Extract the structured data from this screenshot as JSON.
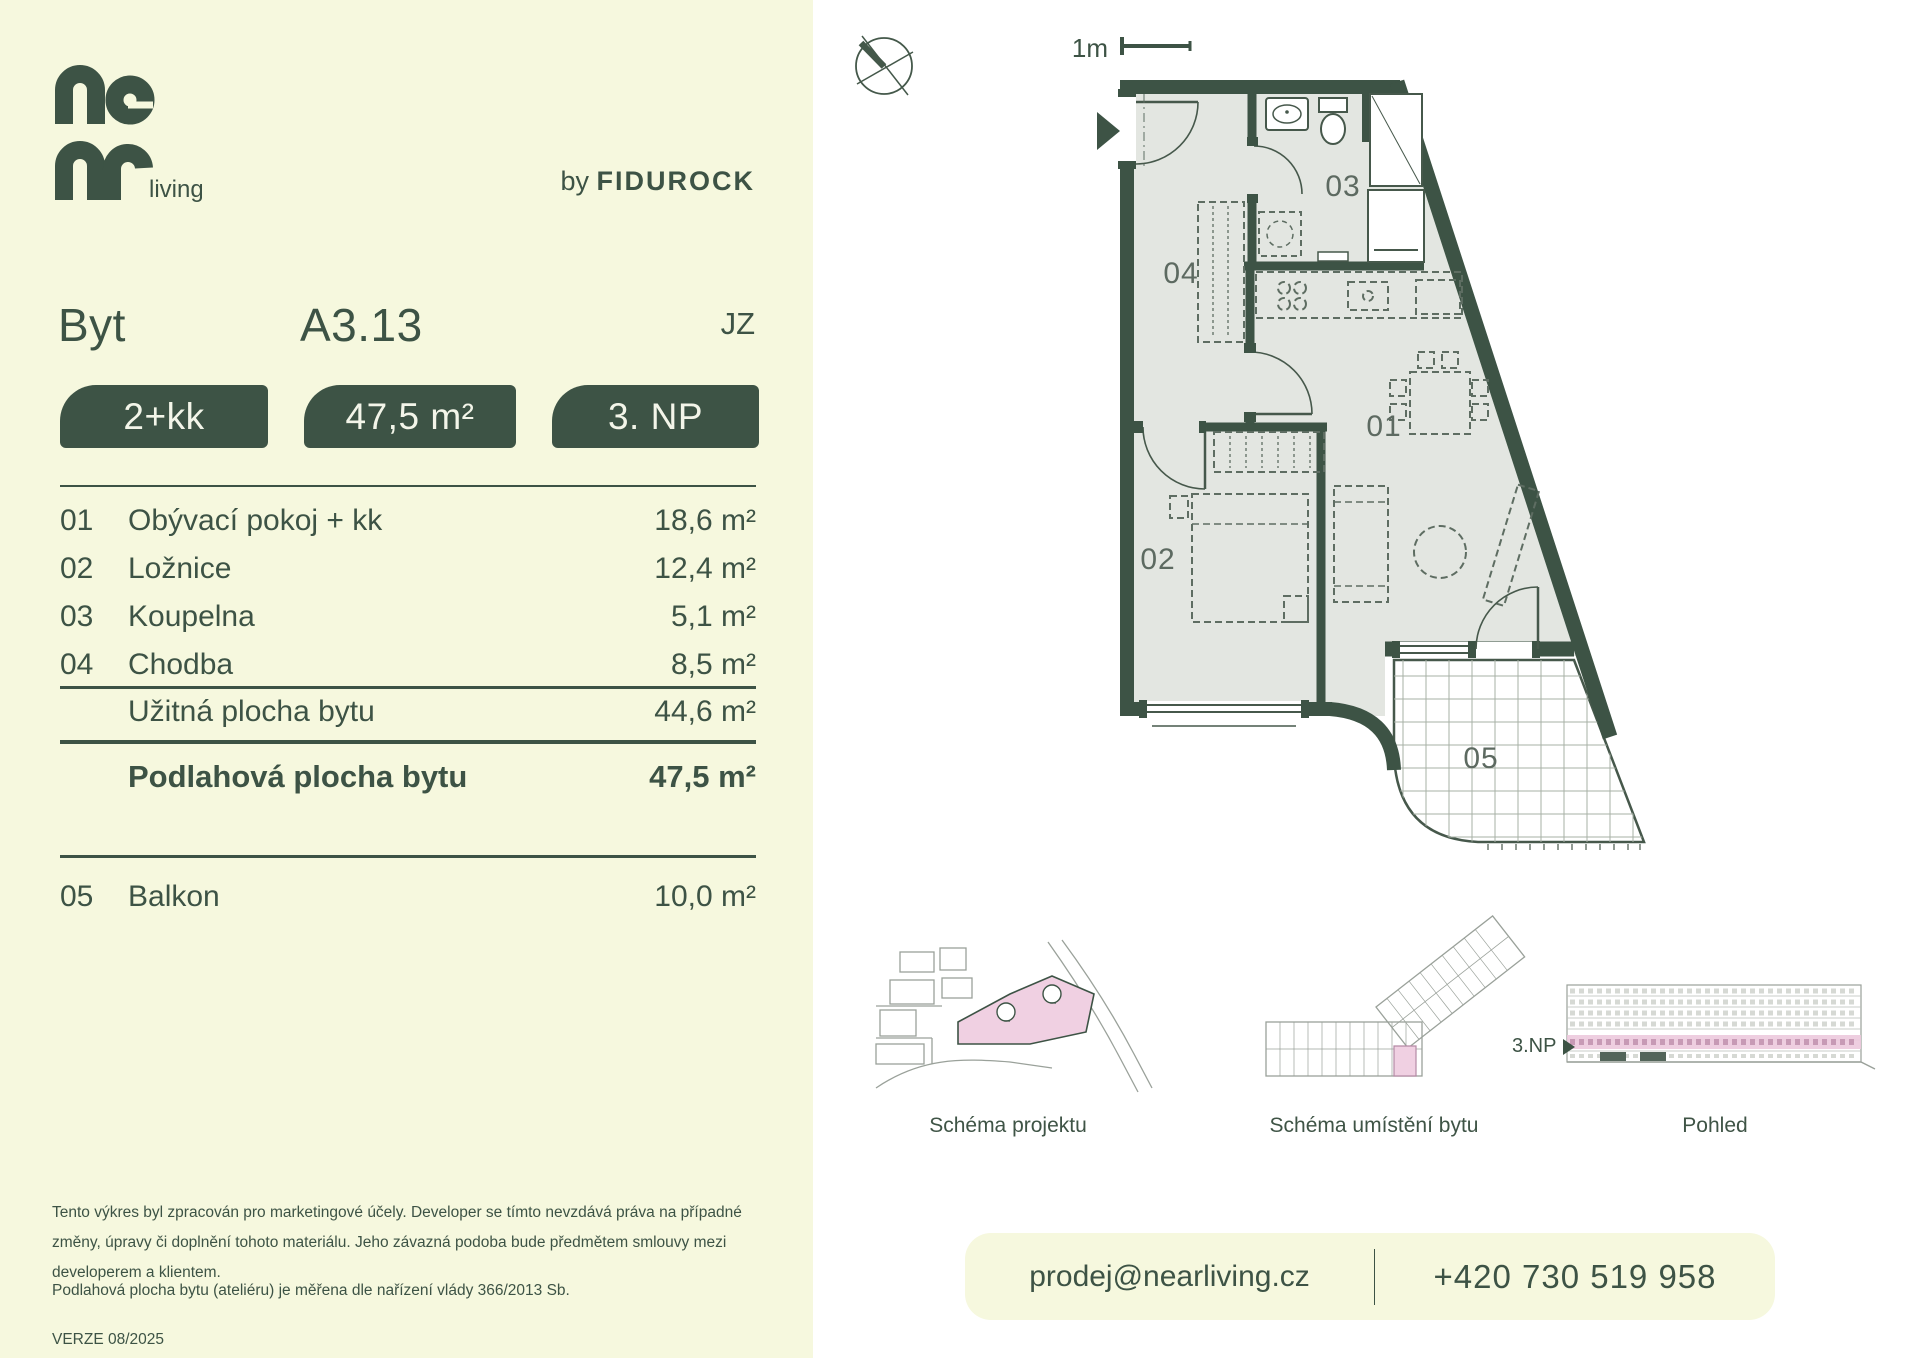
{
  "brand": {
    "logo_text": "near living",
    "logo_suffix": "living",
    "byline_prefix": "by",
    "byline_brand": "FIDUROCK"
  },
  "header": {
    "type_label": "Byt",
    "unit_id": "A3.13",
    "orientation": "JZ"
  },
  "badges": [
    {
      "label": "2+kk"
    },
    {
      "label": "47,5 m²"
    },
    {
      "label": "3. NP"
    }
  ],
  "rooms": [
    {
      "num": "01",
      "name": "Obývací pokoj + kk",
      "area": "18,6 m²"
    },
    {
      "num": "02",
      "name": "Ložnice",
      "area": "12,4 m²"
    },
    {
      "num": "03",
      "name": "Koupelna",
      "area": "5,1 m²"
    },
    {
      "num": "04",
      "name": "Chodba",
      "area": "8,5 m²"
    }
  ],
  "summary": {
    "usable": {
      "name": "Užitná plocha bytu",
      "area": "44,6 m²"
    },
    "floor_area": {
      "name": "Podlahová plocha bytu",
      "area": "47,5 m²"
    },
    "balcony": {
      "num": "05",
      "name": "Balkon",
      "area": "10,0 m²"
    }
  },
  "plan": {
    "scale_label": "1m",
    "room_labels": {
      "r01": "01",
      "r02": "02",
      "r03": "03",
      "r04": "04",
      "r05": "05"
    }
  },
  "schematics": {
    "project": "Schéma projektu",
    "unit_location": "Schéma umístění bytu",
    "elevation": "Pohled",
    "floor_pointer": "3.NP"
  },
  "footer": {
    "disclaimer1": "Tento výkres byl zpracován pro marketingové účely. Developer se tímto nevzdává práva na případné změny, úpravy či doplnění tohoto materiálu. Jeho závazná podoba bude předmětem smlouvy mezi developerem a klientem.",
    "disclaimer2": "Podlahová plocha bytu (ateliéru) je měřena dle nařízení vlády 366/2013 Sb.",
    "version": "VERZE 08/2025"
  },
  "contact": {
    "email": "prodej@nearliving.cz",
    "phone": "+420 730 519 958"
  },
  "colors": {
    "green": "#3d5345",
    "cream": "#f6f8de",
    "floor": "#e3e6e1",
    "pink": "#f0d0e2"
  }
}
